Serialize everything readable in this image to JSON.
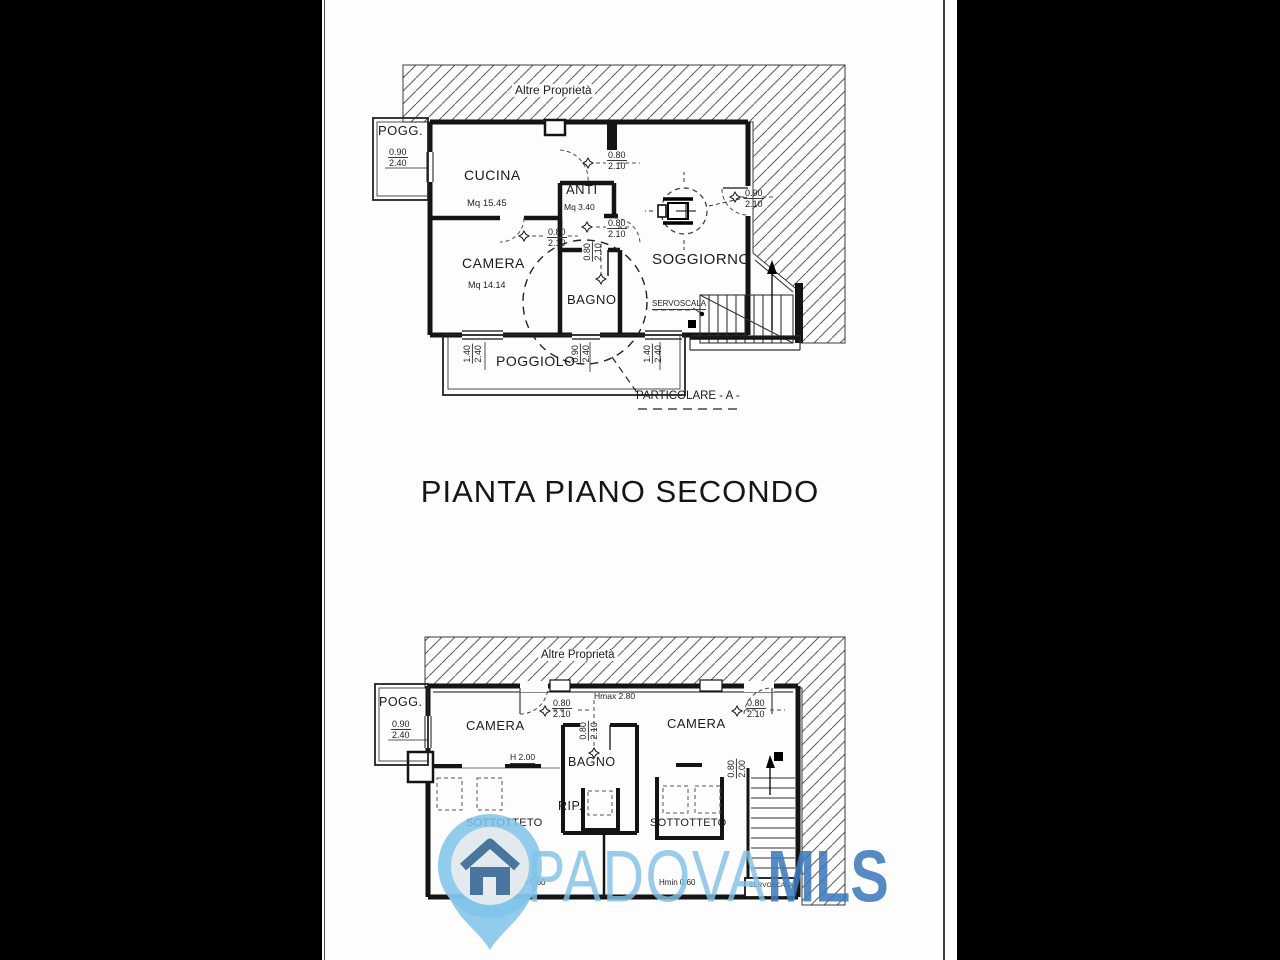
{
  "title": "PIANTA PIANO  SECONDO",
  "plan_top": {
    "boundary_label": "Altre Proprietà",
    "pogg_label": "POGG.",
    "cucina_label": "CUCINA",
    "cucina_area": "Mq 15.45",
    "anti_label": "ANTI",
    "anti_area": "Mq 3.40",
    "camera_label": "CAMERA",
    "camera_area": "Mq 14.14",
    "bagno_label": "BAGNO",
    "soggiorno_label": "SOGGIORNO",
    "servoscala_label": "SERVOSCALA",
    "poggiolo_label": "POGGIOLO",
    "particolare_label": "PARTICOLARE - A -",
    "dims": {
      "pogg": {
        "w": "0.90",
        "h": "2.40"
      },
      "door_top": {
        "w": "0.80",
        "h": "2.10"
      },
      "door_anti": {
        "w": "0.80",
        "h": "2.10"
      },
      "door_camera": {
        "w": "0.80",
        "h": "2.10"
      },
      "door_bagno": {
        "w": "0.80",
        "h": "2.10"
      },
      "door_soggiorno": {
        "w": "0.90",
        "h": "2.10"
      },
      "window_left": {
        "w": "1.40",
        "h": "2.40"
      },
      "window_center": {
        "w": "0.90",
        "h": "2.40"
      },
      "window_right": {
        "w": "1.40",
        "h": "2.40"
      }
    }
  },
  "plan_bottom": {
    "boundary_label": "Altre Proprietà",
    "pogg_label": "POGG.",
    "camera_left_label": "CAMERA",
    "camera_right_label": "CAMERA",
    "bagno_label": "BAGNO",
    "rip_label": "RIP.",
    "sottotteto_left_label": "SOTTOTTETO",
    "sottotteto_right_label": "SOTTOTTETO",
    "servoscala_label": "SERVOSCALA",
    "hmax_label": "Hmax 2.80",
    "h_label": "H 2.00",
    "hmin_left_label": "Hmin 0.60",
    "hmin_right_label": "Hmin 0.60",
    "dims": {
      "pogg": {
        "w": "0.90",
        "h": "2.40"
      },
      "door_left": {
        "w": "0.80",
        "h": "2.10"
      },
      "door_right": {
        "w": "0.80",
        "h": "2.10"
      },
      "door_bagno": {
        "w": "0.80",
        "h": "2.10"
      },
      "stair": {
        "w": "0.80",
        "h": "2.00"
      }
    }
  },
  "watermark": {
    "brand_primary": "PADOVA",
    "brand_secondary": "MLS",
    "colors": {
      "light_blue": "#82c1e5",
      "dark_blue": "#3e7abc",
      "pin_fill": "#7fc3ea",
      "house_blue": "#49759e"
    }
  }
}
